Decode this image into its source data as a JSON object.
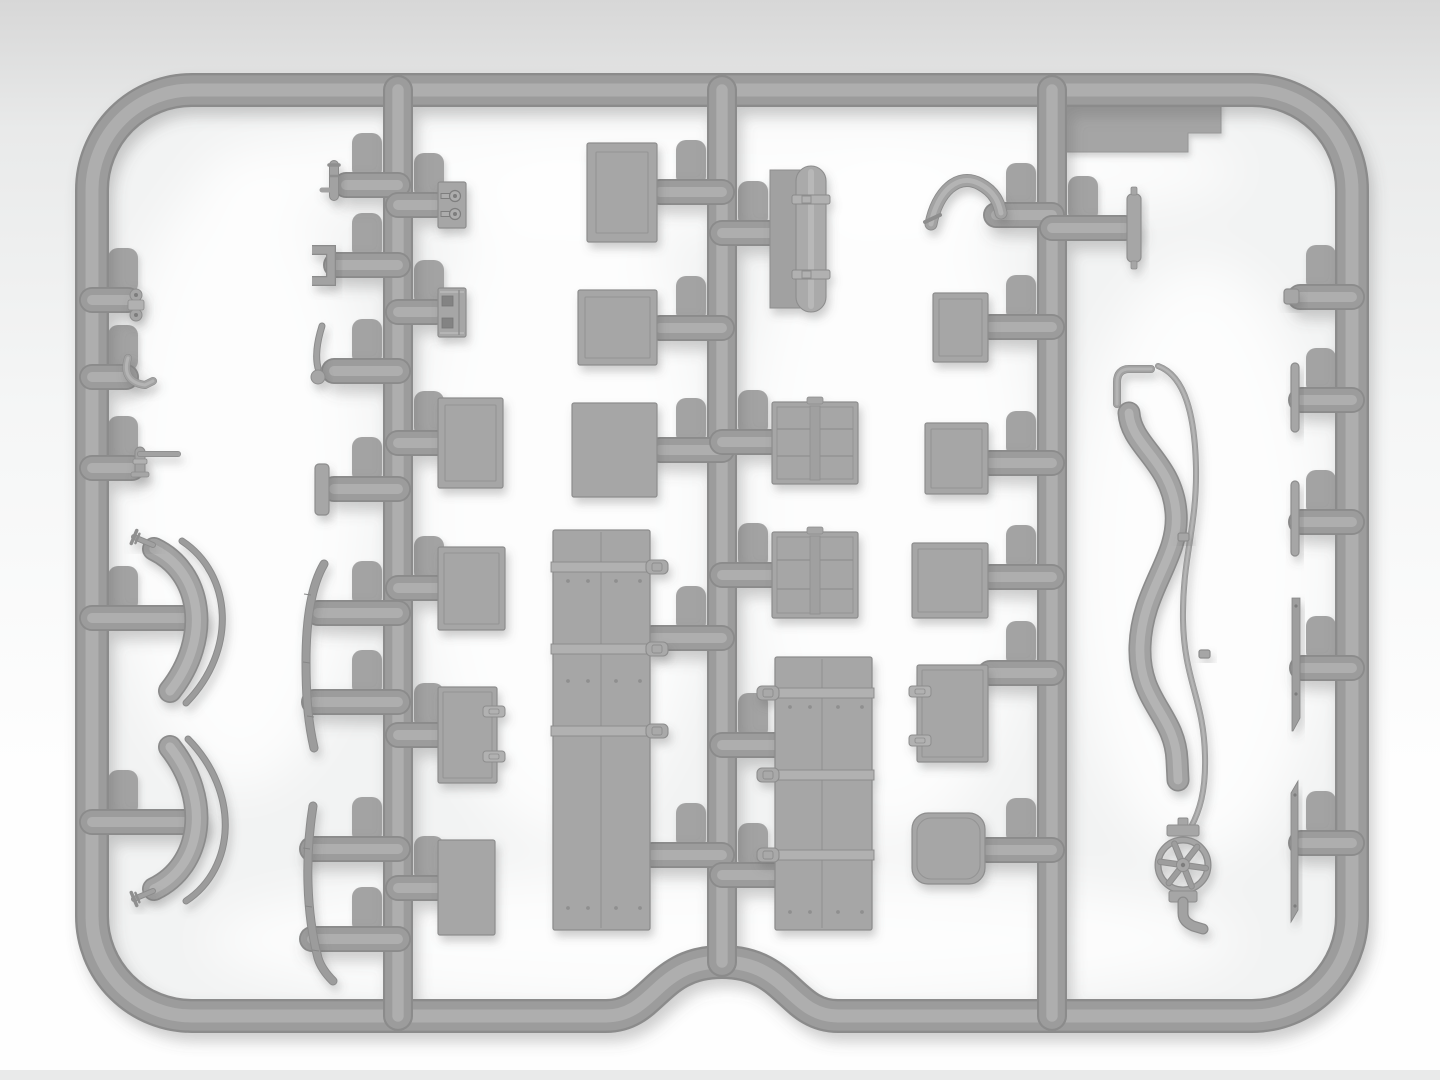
{
  "scene": {
    "title": "gray injection-molded plastic model sprue with stowage parts",
    "canvas": {
      "w": 1440,
      "h": 1080
    },
    "colors": {
      "bg_top": "#d7d7d7",
      "bg_mid1": "#e9eaea",
      "bg_mid2": "#f5f6f6",
      "bg_bottom": "#fefefe",
      "bottom_strip": "#e9eaea",
      "interior_fill": "#f2f3f3",
      "plastic_dark": "#8b8b8b",
      "plastic_mid": "#9c9c9c",
      "plastic_hi": "#aeaeae",
      "part_fill": "#a6a6a6",
      "part_edge": "#8d8d8d",
      "part_line": "#949494",
      "part_mid": "#a2a2a2",
      "part_hi": "#b4b4b4",
      "strap_fill": "#b1b1b1",
      "strap_edge": "#8a8a8a",
      "hole_fill": "#7d7d7d",
      "pad_fill": "#a3a3a3",
      "shadow": "#5f5f5f",
      "glow": "#ffffff"
    },
    "frame": {
      "path": "M 192 90 L 1252 90 A 100 100 0 0 1 1352 190 L 1352 916 A 100 100 0 0 1 1252 1016 L 838 1016 C 790 1016 788 962 722 962 C 656 962 654 1016 606 1016 L 192 1016 A 100 100 0 0 1 92 916 L 92 190 A 100 100 0 0 1 192 90 Z",
      "bar_width": 34
    },
    "runners": [
      {
        "id": "runner-left-inner",
        "line": [
          398,
          90,
          398,
          1016
        ]
      },
      {
        "id": "runner-center",
        "line": [
          722,
          90,
          722,
          962
        ]
      },
      {
        "id": "runner-right-inner",
        "line": [
          1052,
          90,
          1052,
          1016
        ]
      }
    ],
    "runner_width": 30,
    "stub_width": 26,
    "stubs": [
      [
        92,
        300,
        128,
        300
      ],
      [
        92,
        377,
        126,
        377
      ],
      [
        92,
        468,
        132,
        468
      ],
      [
        92,
        618,
        195,
        618
      ],
      [
        92,
        822,
        195,
        822
      ],
      [
        398,
        185,
        346,
        185
      ],
      [
        398,
        265,
        336,
        265
      ],
      [
        398,
        371,
        334,
        371
      ],
      [
        398,
        489,
        334,
        489
      ],
      [
        398,
        613,
        318,
        613
      ],
      [
        398,
        702,
        314,
        702
      ],
      [
        398,
        849,
        312,
        849
      ],
      [
        398,
        939,
        312,
        939
      ],
      [
        398,
        205,
        436,
        205
      ],
      [
        398,
        312,
        436,
        312
      ],
      [
        398,
        443,
        442,
        443
      ],
      [
        398,
        588,
        440,
        588
      ],
      [
        398,
        735,
        440,
        735
      ],
      [
        398,
        888,
        440,
        888
      ],
      [
        722,
        192,
        660,
        192
      ],
      [
        722,
        328,
        660,
        328
      ],
      [
        722,
        450,
        660,
        450
      ],
      [
        722,
        638,
        652,
        638
      ],
      [
        722,
        855,
        652,
        855
      ],
      [
        722,
        233,
        770,
        233
      ],
      [
        722,
        442,
        774,
        442
      ],
      [
        722,
        575,
        774,
        575
      ],
      [
        722,
        745,
        777,
        745
      ],
      [
        722,
        875,
        777,
        875
      ],
      [
        1052,
        215,
        996,
        215
      ],
      [
        1052,
        327,
        990,
        327
      ],
      [
        1052,
        463,
        990,
        463
      ],
      [
        1052,
        577,
        990,
        577
      ],
      [
        1052,
        673,
        990,
        673
      ],
      [
        1052,
        850,
        987,
        850
      ],
      [
        1052,
        228,
        1125,
        228
      ],
      [
        1352,
        297,
        1300,
        297
      ],
      [
        1352,
        400,
        1301,
        400
      ],
      [
        1352,
        522,
        1301,
        522
      ],
      [
        1352,
        668,
        1302,
        668
      ],
      [
        1352,
        843,
        1301,
        843
      ]
    ],
    "glows": [
      [
        240,
        480,
        130,
        310
      ],
      [
        560,
        500,
        150,
        340
      ],
      [
        890,
        500,
        150,
        340
      ],
      [
        1200,
        560,
        130,
        300
      ],
      [
        722,
        170,
        520,
        60
      ],
      [
        722,
        940,
        520,
        70
      ]
    ],
    "underlay_parts": [
      {
        "id": "brand-plate",
        "type": "plate",
        "d": "M 1066 97 L 1221 97 L 1221 133 L 1188 133 L 1188 152 L 1066 152 Z"
      }
    ],
    "parts": [
      {
        "id": "small-clamp-fitting",
        "type": "clamp",
        "cx": 136,
        "cy": 305
      },
      {
        "id": "hook-pipe-fitting",
        "type": "barpath",
        "d": "M 128 358 C 123 374 130 383 145 385 L 153 381",
        "sw": 8
      },
      {
        "id": "elbow-pipe-fitting",
        "type": "elbow",
        "x": 140,
        "y": 452,
        "armX": 178,
        "footY": 472
      },
      {
        "id": "fender-arc-upper",
        "type": "barpath",
        "d": "M 154 549 C 202 572 212 638 170 691",
        "sw": 24
      },
      {
        "id": "fender-trim-upper",
        "type": "thinarc",
        "d": "M 182 541 C 232 574 238 650 186 703",
        "sw": 5
      },
      {
        "id": "fender-pin-upper",
        "type": "pin",
        "ax": 134,
        "ay": 537,
        "bx": 153,
        "by": 545
      },
      {
        "id": "fender-arc-lower",
        "type": "barpath",
        "d": "M 154 889 C 202 866 212 800 170 747",
        "sw": 24
      },
      {
        "id": "fender-trim-lower",
        "type": "thinarc",
        "d": "M 186 901 C 236 868 240 792 188 739",
        "sw": 5
      },
      {
        "id": "fender-pin-lower",
        "type": "pin",
        "ax": 134,
        "ay": 899,
        "bx": 153,
        "by": 891
      },
      {
        "id": "running-board-strip-upper",
        "type": "thinarc",
        "d": "M 324 564 C 311 586 306 622 306 662 C 306 702 309 726 314 748",
        "sw": 7,
        "ticks": [
          [
            307,
            594
          ],
          [
            306,
            662
          ],
          [
            310,
            716
          ]
        ]
      },
      {
        "id": "running-board-strip-lower",
        "type": "thinarc",
        "d": "M 313 806 C 305 856 306 912 318 958 C 321 968 327 975 333 981",
        "sw": 7,
        "ticks": [
          [
            306,
            848
          ],
          [
            308,
            906
          ],
          [
            315,
            950
          ]
        ]
      },
      {
        "id": "tap-fitting",
        "type": "tap",
        "x": 334,
        "y": 165
      },
      {
        "id": "u-bracket",
        "type": "ubracket",
        "x": 312,
        "y": 250,
        "w": 19,
        "h": 31
      },
      {
        "id": "shift-lever",
        "type": "lever",
        "d": "M 322 326 C 317 342 315 356 318 368",
        "cx": 318,
        "cy": 377,
        "r": 7
      },
      {
        "id": "small-plank",
        "type": "box",
        "x": 315,
        "y": 464,
        "w": 14,
        "h": 51,
        "rx": 4,
        "inset": 0
      },
      {
        "id": "buckle-plate",
        "type": "keyplate",
        "x": 438,
        "y": 182,
        "w": 28,
        "h": 46
      },
      {
        "id": "latch-plate",
        "type": "holeplate",
        "x": 438,
        "y": 288,
        "w": 28,
        "h": 49
      },
      {
        "id": "crate-lid-small",
        "type": "box",
        "x": 438,
        "y": 398,
        "w": 65,
        "h": 90,
        "inset": 7
      },
      {
        "id": "crate-bordered",
        "type": "box",
        "x": 438,
        "y": 547,
        "w": 67,
        "h": 83,
        "inset": 6
      },
      {
        "id": "crate-latched",
        "type": "box",
        "x": 438,
        "y": 687,
        "w": 59,
        "h": 96,
        "inset": 5,
        "latch": "R",
        "latchYs": [
          706,
          751
        ]
      },
      {
        "id": "box-plain-a",
        "type": "box",
        "x": 438,
        "y": 840,
        "w": 57,
        "h": 95,
        "inset": 0
      },
      {
        "id": "crate-lid-large",
        "type": "box",
        "x": 587,
        "y": 143,
        "w": 70,
        "h": 99,
        "inset": 9
      },
      {
        "id": "crate-lid-medium",
        "type": "box",
        "x": 578,
        "y": 290,
        "w": 79,
        "h": 75,
        "inset": 7
      },
      {
        "id": "box-plain-b",
        "type": "box",
        "x": 572,
        "y": 403,
        "w": 85,
        "h": 94,
        "inset": 0
      },
      {
        "id": "stowage-locker",
        "type": "locker",
        "x": 553,
        "y": 530,
        "w": 97,
        "h": 400,
        "seam": 601,
        "straps": [
          562,
          644,
          726
        ],
        "buckle": "R",
        "rivets": [
          {
            "y": 581,
            "xs": [
              568,
              588,
              616,
              640
            ]
          },
          {
            "y": 681,
            "xs": [
              568,
              588,
              616,
              640
            ]
          },
          {
            "y": 908,
            "xs": [
              568,
              588,
              616,
              640
            ]
          }
        ]
      },
      {
        "id": "tarp-roll",
        "type": "tarp",
        "px": 770,
        "py": 170,
        "pw": 50,
        "ph": 138,
        "rx": 796,
        "ry": 166,
        "rw": 30,
        "rh": 146,
        "straps": [
          195,
          270
        ]
      },
      {
        "id": "exhaust-pipe",
        "type": "barpath",
        "d": "M 931 224 C 937 192 958 172 980 184 C 995 192 999 203 1001 213",
        "sw": 13,
        "flange": [
          925,
          222,
          940,
          215
        ]
      },
      {
        "id": "crate-sq-a",
        "type": "box",
        "x": 933,
        "y": 293,
        "w": 55,
        "h": 69,
        "inset": 6
      },
      {
        "id": "panel-crate-a",
        "type": "panelcrate",
        "x": 772,
        "y": 402,
        "w": 86,
        "h": 82,
        "rows": [
          429,
          456
        ],
        "tab": true
      },
      {
        "id": "crate-sq-b",
        "type": "box",
        "x": 925,
        "y": 423,
        "w": 63,
        "h": 71,
        "inset": 6
      },
      {
        "id": "panel-crate-b",
        "type": "panelcrate",
        "x": 772,
        "y": 532,
        "w": 86,
        "h": 86,
        "rows": [
          560,
          589
        ],
        "tab": true
      },
      {
        "id": "crate-sq-c",
        "type": "box",
        "x": 912,
        "y": 543,
        "w": 76,
        "h": 75,
        "inset": 6
      },
      {
        "id": "stowage-chest",
        "type": "locker",
        "x": 775,
        "y": 657,
        "w": 97,
        "h": 273,
        "seam": 822,
        "straps": [
          688,
          770,
          850
        ],
        "buckle": "L",
        "rivets": [
          {
            "y": 707,
            "xs": [
              790,
              810,
              838,
              862
            ]
          },
          {
            "y": 912,
            "xs": [
              790,
              810,
              838,
              862
            ]
          }
        ]
      },
      {
        "id": "latched-box",
        "type": "box",
        "x": 917,
        "y": 665,
        "w": 71,
        "h": 97,
        "inset": 5,
        "latch": "L",
        "latchYs": [
          686,
          735
        ]
      },
      {
        "id": "soft-case",
        "type": "box",
        "x": 912,
        "y": 813,
        "w": 73,
        "h": 71,
        "rx": 16,
        "inset": 5
      },
      {
        "id": "pin-bar",
        "type": "pinbar",
        "x": 1127,
        "y": 194,
        "w": 14,
        "h": 68
      },
      {
        "id": "square-nub",
        "type": "box",
        "x": 1284,
        "y": 289,
        "w": 15,
        "h": 15,
        "rx": 3,
        "inset": 0
      },
      {
        "id": "hose-hook",
        "type": "barpath",
        "d": "M 1151 369 L 1129 369 C 1121 369 1117 374 1117 382 L 1117 404",
        "sw": 8
      },
      {
        "id": "fuel-hose",
        "type": "barpath",
        "d": "M 1129 413 C 1131 446 1172 462 1176 512 C 1180 558 1142 588 1140 646 C 1138 702 1175 714 1177 760 L 1178 780",
        "sw": 23
      },
      {
        "id": "fuel-line",
        "type": "barpath",
        "d": "M 1158 366 C 1186 376 1195 418 1196 468 C 1197 528 1182 558 1183 620 C 1184 680 1204 700 1205 756 C 1206 792 1199 812 1191 827",
        "sw": 6
      },
      {
        "id": "line-collar-a",
        "type": "box",
        "x": 1178,
        "y": 533,
        "w": 11,
        "h": 8,
        "rx": 2,
        "inset": 0
      },
      {
        "id": "line-collar-b",
        "type": "box",
        "x": 1199,
        "y": 650,
        "w": 11,
        "h": 8,
        "rx": 2,
        "inset": 0
      },
      {
        "id": "valve-handwheel",
        "type": "valve",
        "cx": 1183,
        "cy": 865,
        "r": 25
      },
      {
        "id": "runner-stub-capsule",
        "type": "capsule",
        "x1": 1070,
        "y1": 866,
        "x2": 1138,
        "y2": 866,
        "sw": 28
      },
      {
        "id": "strip-short-a",
        "type": "box",
        "x": 1291,
        "y": 363,
        "w": 8,
        "h": 69,
        "rx": 4,
        "inset": 0
      },
      {
        "id": "strip-short-b",
        "type": "box",
        "x": 1291,
        "y": 481,
        "w": 8,
        "h": 75,
        "rx": 4,
        "inset": 0
      },
      {
        "id": "strip-long-a",
        "type": "blade",
        "d": "M 1292 598 L 1300 598 L 1300 718 L 1293 731 L 1292 731 Z",
        "holes": [
          [
            1296,
            606
          ],
          [
            1296,
            694
          ]
        ]
      },
      {
        "id": "strip-long-b",
        "type": "blade",
        "d": "M 1291 793 L 1298 781 L 1298 910 L 1291 922 Z",
        "holes": [
          [
            1295,
            795
          ],
          [
            1295,
            906
          ]
        ]
      }
    ]
  }
}
